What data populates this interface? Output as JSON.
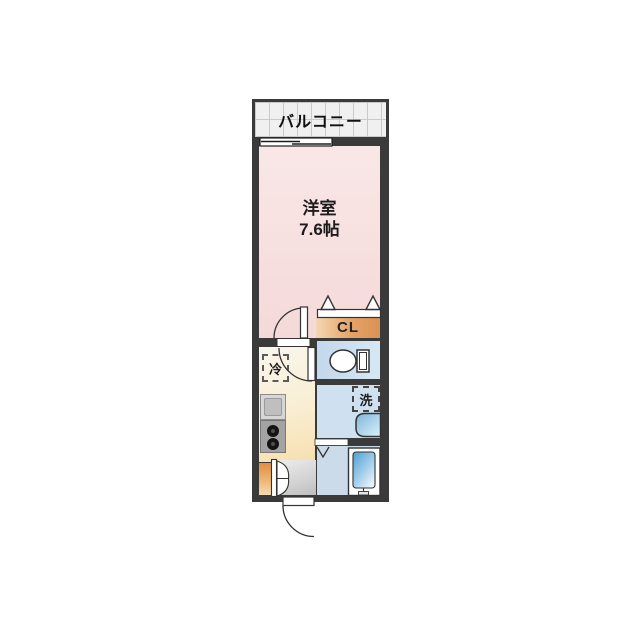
{
  "plan": {
    "balcony": {
      "label": "バルコニー"
    },
    "main_room": {
      "name": "洋室",
      "size": "7.6帖"
    },
    "closet": {
      "label": "CL"
    },
    "refrigerator": {
      "label": "冷"
    },
    "washer": {
      "label": "洗"
    }
  },
  "colors": {
    "wall": "#3a3a3a",
    "main_room_pink": "#f7dfdf",
    "closet_orange": "#e4a369",
    "water_room_blue": "#cfe1f0",
    "bath_floor_blue": "#ccdbea",
    "bathtub_blue": "#58a4d6",
    "kitchen_cream": "#f9eed3",
    "entrance_cabinet_orange": "#e08e42",
    "genkan_gray": "#d2d2d2",
    "balcony_floor_gray": "#f0f0f0"
  }
}
